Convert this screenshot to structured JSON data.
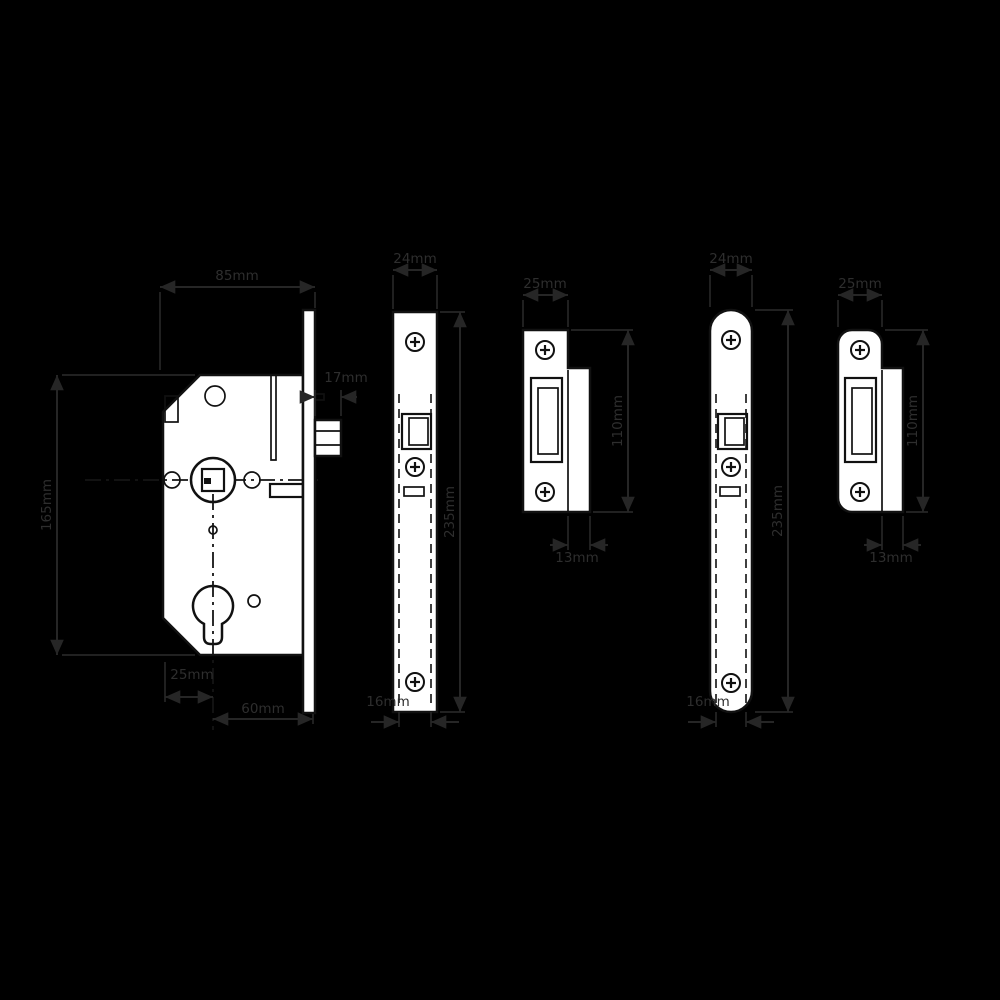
{
  "colors": {
    "background": "#000000",
    "shape_fill": "#ffffff",
    "drawing_line": "#111111",
    "dimension_line": "#262626",
    "dimension_text": "#2e2e2e"
  },
  "views": {
    "lock_case": {
      "name": "lock case side view",
      "case_depth": "85mm",
      "case_height": "165mm",
      "latch_projection": "17mm",
      "rear_to_centre": "25mm",
      "backset": "60mm"
    },
    "square_forend": {
      "name": "square forend front view",
      "width": "24mm",
      "height": "235mm",
      "case_thickness": "16mm"
    },
    "square_strike": {
      "name": "square strike plate",
      "width": "25mm",
      "height": "110mm",
      "lip": "13mm"
    },
    "radius_forend": {
      "name": "radius forend front view",
      "width": "24mm",
      "height": "235mm",
      "case_thickness": "16mm"
    },
    "radius_strike": {
      "name": "radius strike plate",
      "width": "25mm",
      "height": "110mm",
      "lip": "13mm"
    }
  }
}
